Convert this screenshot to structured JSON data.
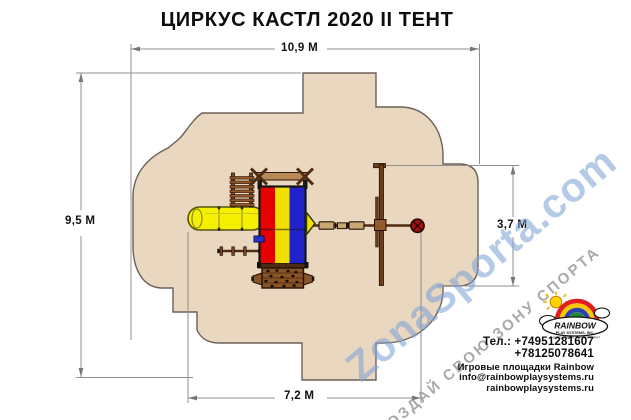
{
  "title": "ЦИРКУС КАСТЛ 2020 II ТЕНТ",
  "dimensions": {
    "overall_width": "10,9 М",
    "overall_height": "9,5 М",
    "swing_bay_depth": "3,7 М",
    "lower_width": "7,2 М"
  },
  "watermark": {
    "brand": "ZonaSporta.com",
    "slogan": "СОЗДАЙ СВОЮ ЗОНУ СПОРТА"
  },
  "logo": {
    "name": "RAINBOW",
    "subtitle": "PLAY SYSTEMS, INC.",
    "tagline": "THE RESIDENTIAL PLAY EQUIPMENT"
  },
  "contacts": {
    "phone1": "Тел.: +74951281607",
    "phone2": "+78125078641",
    "caption": "Игровые площадки Rainbow",
    "email": "info@rainbowplaysystems.ru",
    "site": "rainbowplaysystems.ru"
  },
  "colors": {
    "safety_zone": "#ead7bf",
    "zone_outline": "#6b6159",
    "wood_brown": "#7b4a1e",
    "wood_dark": "#4e2c12",
    "slide_yellow": "#f4f000",
    "tent_red": "#e60000",
    "tent_yellow": "#f0e000",
    "tent_blue": "#2222cc",
    "tire_swing_red": "#a11212",
    "dimension_gray": "#8f8f8f",
    "watermark_blue": "#80a3d5",
    "watermark_gray": "#919191"
  }
}
